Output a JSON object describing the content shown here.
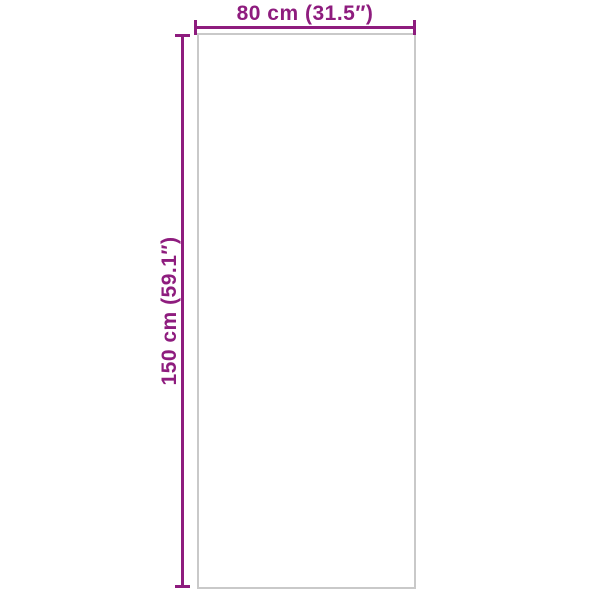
{
  "diagram": {
    "type": "product-dimension-diagram",
    "width_label": "80 cm (31.5″)",
    "height_label": "150 cm (59.1″)",
    "width_value_cm": 80,
    "width_value_inch": 31.5,
    "height_value_cm": 150,
    "height_value_inch": 59.1,
    "accent_color": "#8e1c7e",
    "outline_color": "#c9c9c9",
    "background_color": "#ffffff"
  }
}
